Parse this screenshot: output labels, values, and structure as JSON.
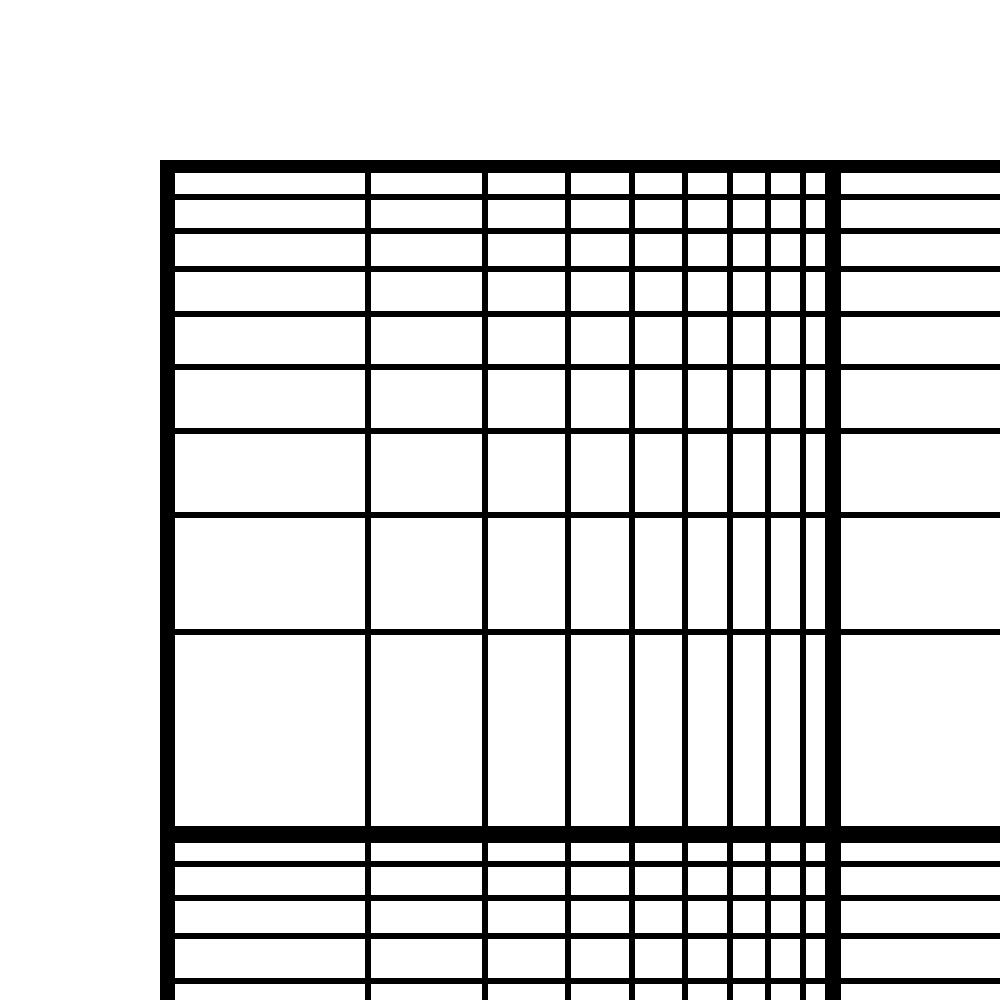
{
  "canvas": {
    "width": 1000,
    "height": 1000,
    "background_color": "#ffffff"
  },
  "grid": {
    "description": "blank log-log graph paper, top-left corner of grid visible; no axis labels, ticks, or data plotted",
    "line_color": "#000000",
    "area": {
      "left": 160,
      "top": 160,
      "right": 1000,
      "bottom": 1000
    },
    "x_scale": "log",
    "y_scale": "log",
    "vertical_lines": [
      {
        "role": "major",
        "center": 167,
        "thickness": 15
      },
      {
        "role": "minor",
        "center": 368,
        "thickness": 6
      },
      {
        "role": "minor",
        "center": 485,
        "thickness": 6
      },
      {
        "role": "minor",
        "center": 568,
        "thickness": 6
      },
      {
        "role": "minor",
        "center": 632,
        "thickness": 6
      },
      {
        "role": "minor",
        "center": 685,
        "thickness": 6
      },
      {
        "role": "minor",
        "center": 730,
        "thickness": 6
      },
      {
        "role": "minor",
        "center": 768,
        "thickness": 6
      },
      {
        "role": "minor",
        "center": 803,
        "thickness": 6
      },
      {
        "role": "major",
        "center": 833,
        "thickness": 16
      }
    ],
    "horizontal_lines": [
      {
        "role": "major",
        "center": 166,
        "thickness": 13
      },
      {
        "role": "minor",
        "center": 197,
        "thickness": 6
      },
      {
        "role": "minor",
        "center": 231,
        "thickness": 6
      },
      {
        "role": "minor",
        "center": 269,
        "thickness": 6
      },
      {
        "role": "minor",
        "center": 314,
        "thickness": 6
      },
      {
        "role": "minor",
        "center": 367,
        "thickness": 6
      },
      {
        "role": "minor",
        "center": 431,
        "thickness": 6
      },
      {
        "role": "minor",
        "center": 515,
        "thickness": 6
      },
      {
        "role": "minor",
        "center": 632,
        "thickness": 6
      },
      {
        "role": "major",
        "center": 834,
        "thickness": 17
      },
      {
        "role": "minor",
        "center": 864,
        "thickness": 6
      },
      {
        "role": "minor",
        "center": 898,
        "thickness": 6
      },
      {
        "role": "minor",
        "center": 936,
        "thickness": 6
      },
      {
        "role": "minor",
        "center": 981,
        "thickness": 6
      }
    ]
  }
}
